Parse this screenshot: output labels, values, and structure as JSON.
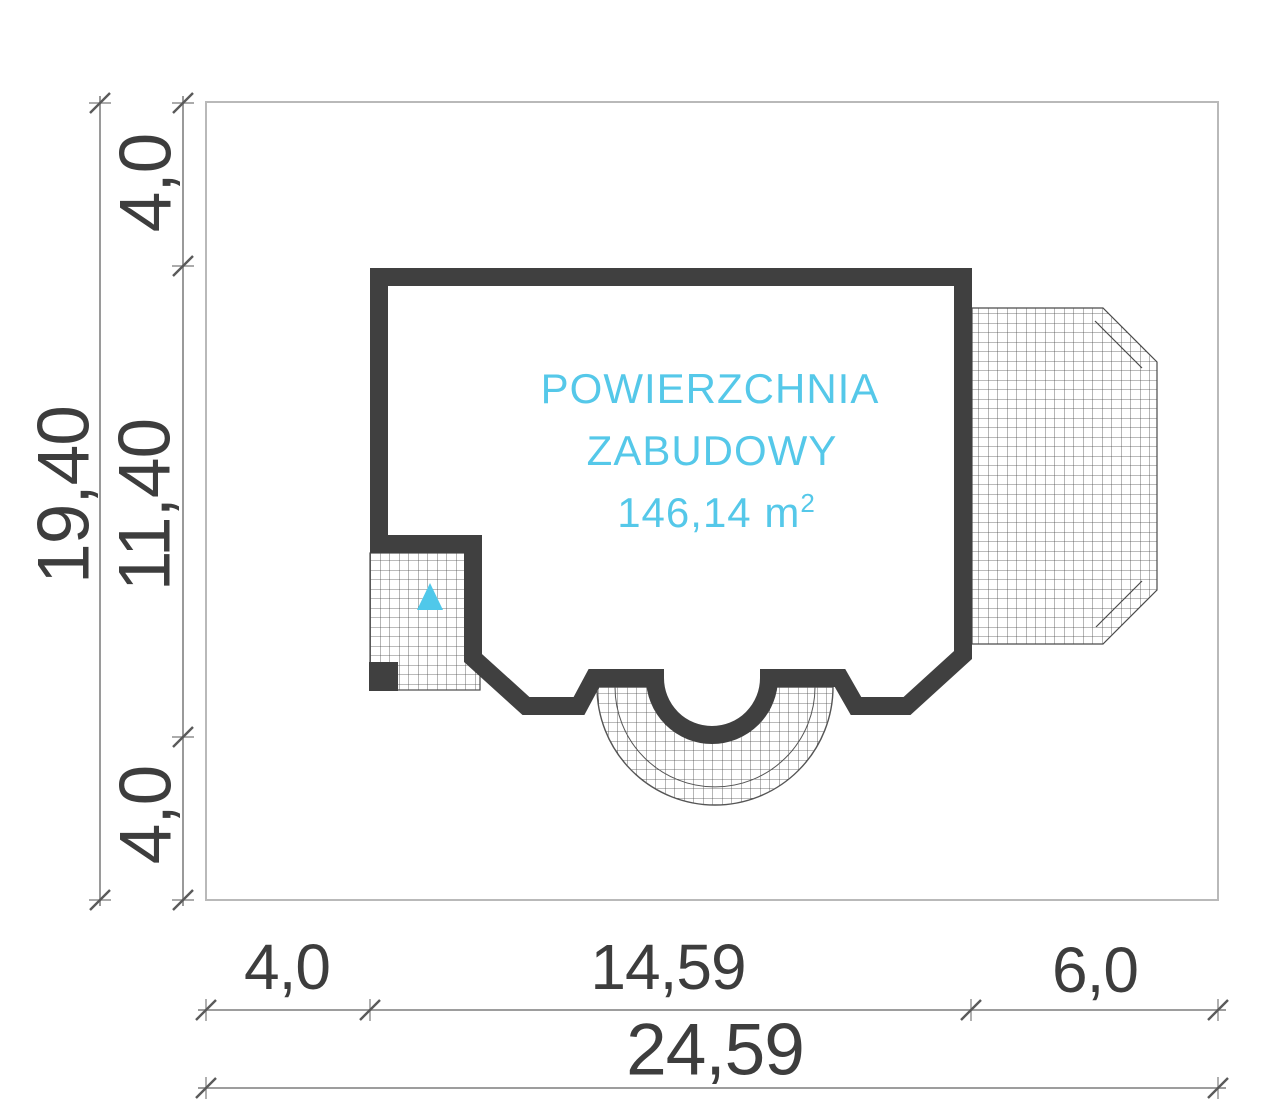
{
  "drawing": {
    "area_label": {
      "line1": "POWIERZCHNIA",
      "line2": "ZABUDOWY",
      "area_value": "146,14",
      "area_unit": "m",
      "area_exponent": "2"
    },
    "dimensions": {
      "left_total": "19,40",
      "left_top_segment": "4,0",
      "left_middle_segment": "11,40",
      "left_bottom_segment": "4,0",
      "bottom_left_segment": "4,0",
      "bottom_middle_segment": "14,59",
      "bottom_right_segment": "6,0",
      "bottom_total": "24,59"
    },
    "colors": {
      "wall": "#404040",
      "accent_cyan": "#55c8e9",
      "dim_line": "#8f8f8f",
      "dim_text": "#3d3d3d",
      "plot_border": "#b9b9b9",
      "hatch_line": "#4a4a4a"
    }
  }
}
